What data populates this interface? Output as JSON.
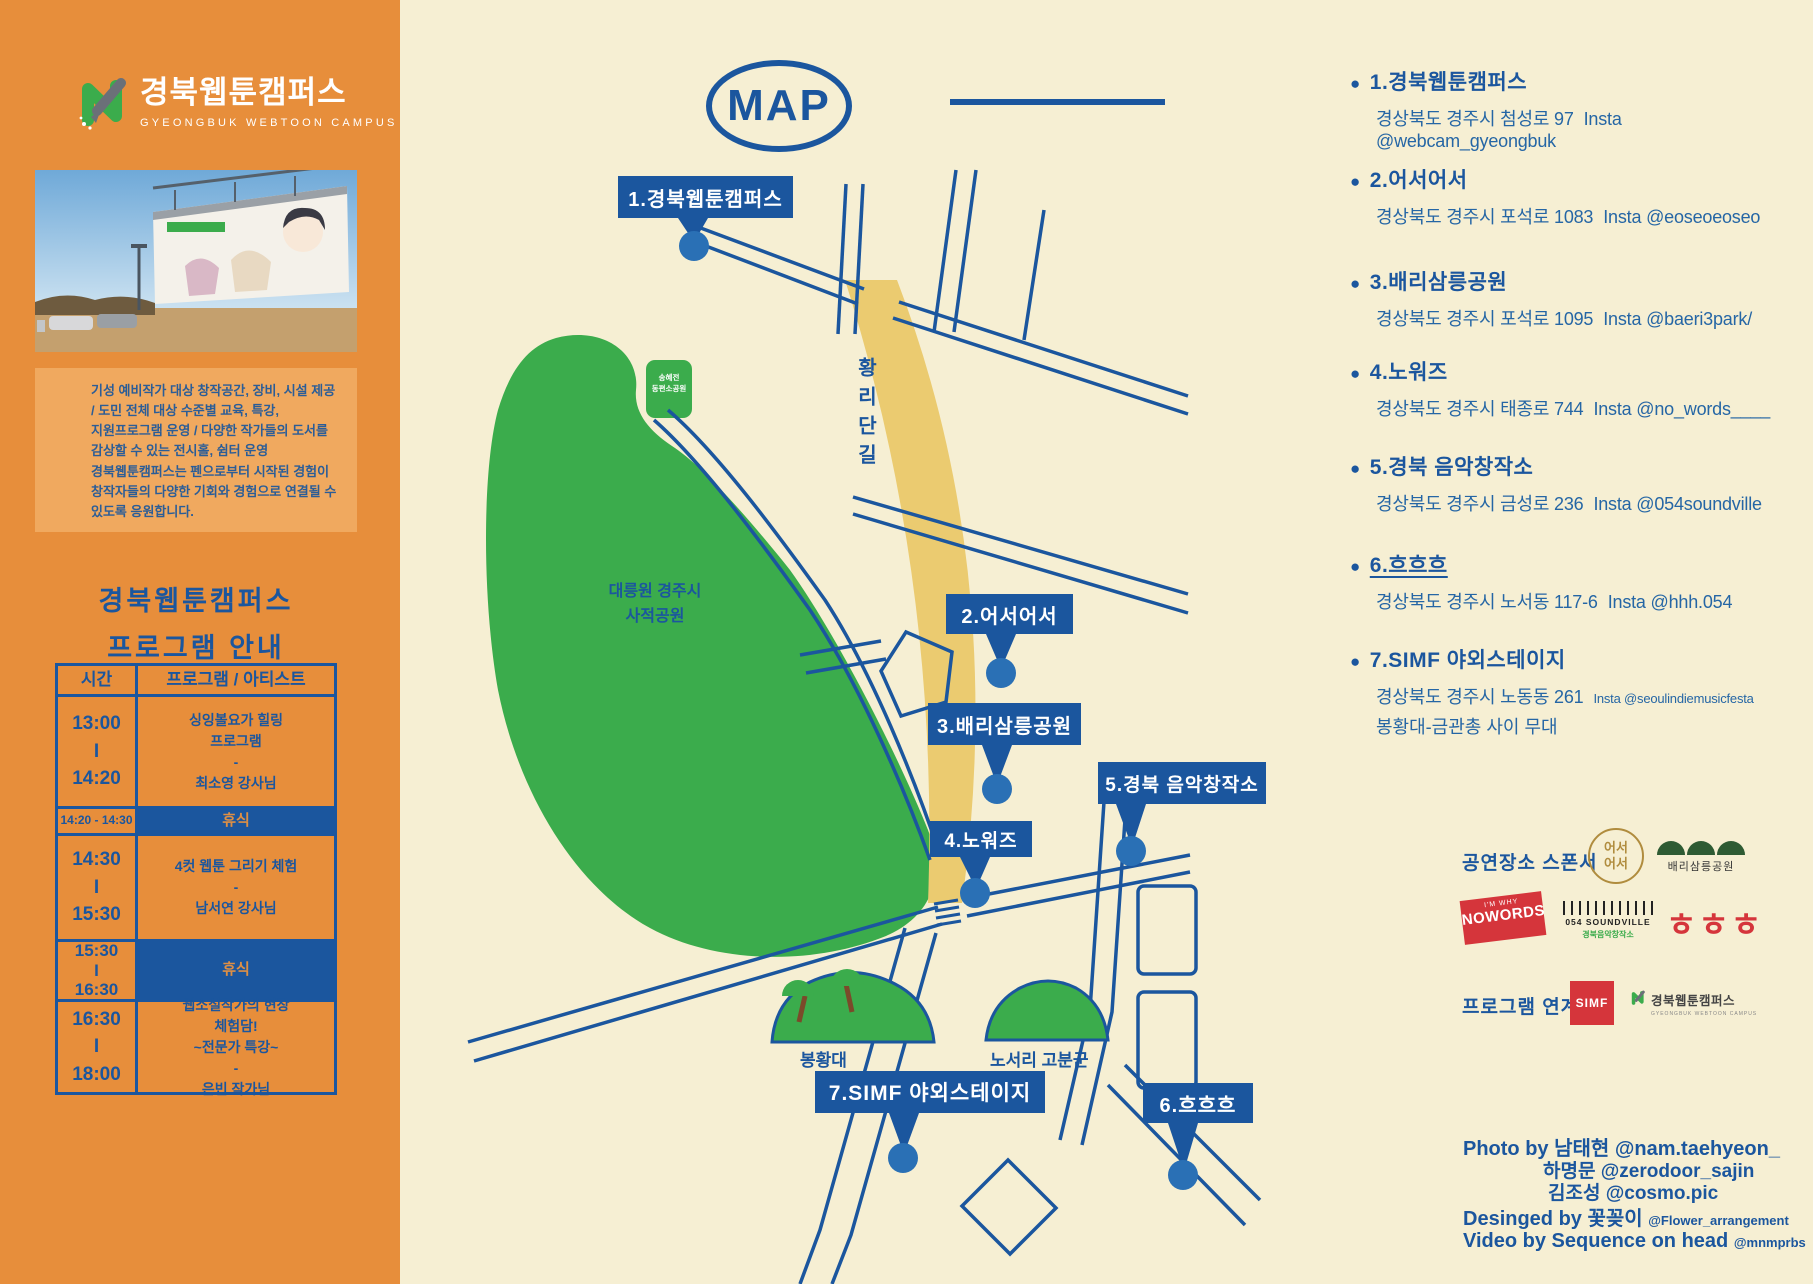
{
  "palette": {
    "orange": "#E78E3B",
    "orange_light": "#F0A95F",
    "cream": "#F6EFD3",
    "blue": "#1B569E",
    "dot_blue": "#2A70B5",
    "green": "#3BAC4C",
    "road_yellow": "#EBCB70",
    "red": "#D5353B",
    "gold": "#B08C3E"
  },
  "brand": {
    "title": "경북웹툰캠퍼스",
    "subtitle": "GYEONGBUK WEBTOON CAMPUS"
  },
  "intro": {
    "text": "기성 예비작가 대상 창작공간, 장비, 시설 제공\n/ 도민 전체 대상 수준별 교육, 특강,\n지원프로그램 운영 / 다양한 작가들의 도서를\n감상할 수 있는 전시홀, 쉼터 운영\n경북웹툰캠퍼스는 펜으로부터 시작된 경험이\n창작자들의 다양한 기회와 경험으로 연결될 수\n있도록 응원합니다."
  },
  "program": {
    "title": "경북웹툰캠퍼스\n프로그램 안내",
    "headers": [
      "시간",
      "프로그램 / 아티스트"
    ],
    "rows": [
      {
        "time": "13:00\nI\n14:20",
        "program": "싱잉볼요가 힐링\n프로그램\n-\n최소영 강사님"
      },
      {
        "time": "14:20 - 14:30",
        "program": "휴식"
      },
      {
        "time": "14:30\nI\n15:30",
        "program": "4컷 웹툰 그리기 체험\n-\n남서연 강사님"
      },
      {
        "time": "15:30\nI\n16:30",
        "program": "휴식"
      },
      {
        "time": "16:30\nI\n18:00",
        "program": "웹소설작가의 현장\n체험담!\n~전문가 특강~\n-\n은빈 작가님"
      }
    ]
  },
  "map": {
    "title": "MAP",
    "road_label": "황리단길",
    "park_label": "대릉원 경주시\n사적공원",
    "park_sign": "송혜전\n동편소공원",
    "mound1": "봉황대",
    "mound2": "노서리 고분군",
    "markers": [
      "1.경북웹툰캠퍼스",
      "2.어서어서",
      "3.배리삼릉공원",
      "4.노워즈",
      "5.경북 음악창작소",
      "6.흐흐흐",
      "7.SIMF 야외스테이지"
    ]
  },
  "locations": [
    {
      "name": "1.경북웹툰캠퍼스",
      "address": "경상북도 경주시 첨성로 97",
      "insta": "Insta @webcam_gyeongbuk"
    },
    {
      "name": "2.어서어서",
      "address": "경상북도 경주시 포석로 1083",
      "insta": "Insta @eoseoeoseo"
    },
    {
      "name": "3.배리삼릉공원",
      "address": "경상북도 경주시 포석로 1095",
      "insta": "Insta @baeri3park/"
    },
    {
      "name": "4.노워즈",
      "address": "경상북도 경주시 태종로 744",
      "insta": "Insta @no_words____"
    },
    {
      "name": "5.경북 음악창작소",
      "address": "경상북도 경주시 금성로 236",
      "insta": "Insta @054soundville"
    },
    {
      "name": "6.흐흐흐",
      "address": "경상북도 경주시 노서동 117-6",
      "insta": "Insta @hhh.054"
    },
    {
      "name": "7.SIMF 야외스테이지",
      "address": "경상북도 경주시 노동동 261",
      "insta": "Insta @seoulindiemusicfesta",
      "note": "봉황대-금관총 사이 무대"
    }
  ],
  "sponsors": {
    "venue_label": "공연장소 스폰서",
    "eoseo_logo": "어서\n어서",
    "baeri_logo": "배리삼릉공원",
    "nowords_top": "I'M WHY",
    "nowords": "NOWORDS",
    "soundville": "054 SOUNDVILLE",
    "soundville_sub": "경북음악창작소",
    "hhh": "ㅎㅎㅎ",
    "program_label": "프로그램 연계",
    "simf": "SIMF",
    "campus": "경북웹툰캠퍼스",
    "campus_sub": "GYEONGBUK WEBTOON CAMPUS"
  },
  "credits": {
    "photo_line1": "Photo by 남태현 @nam.taehyeon_",
    "photo_line2": "하명문 @zerodoor_sajin",
    "photo_line3": "김조성 @cosmo.pic",
    "design_line": "Desinged by 꽃꽂이",
    "design_handle": "@Flower_arrangement",
    "video_line": "Video by Sequence on head",
    "video_handle": "@mnmprbs"
  }
}
